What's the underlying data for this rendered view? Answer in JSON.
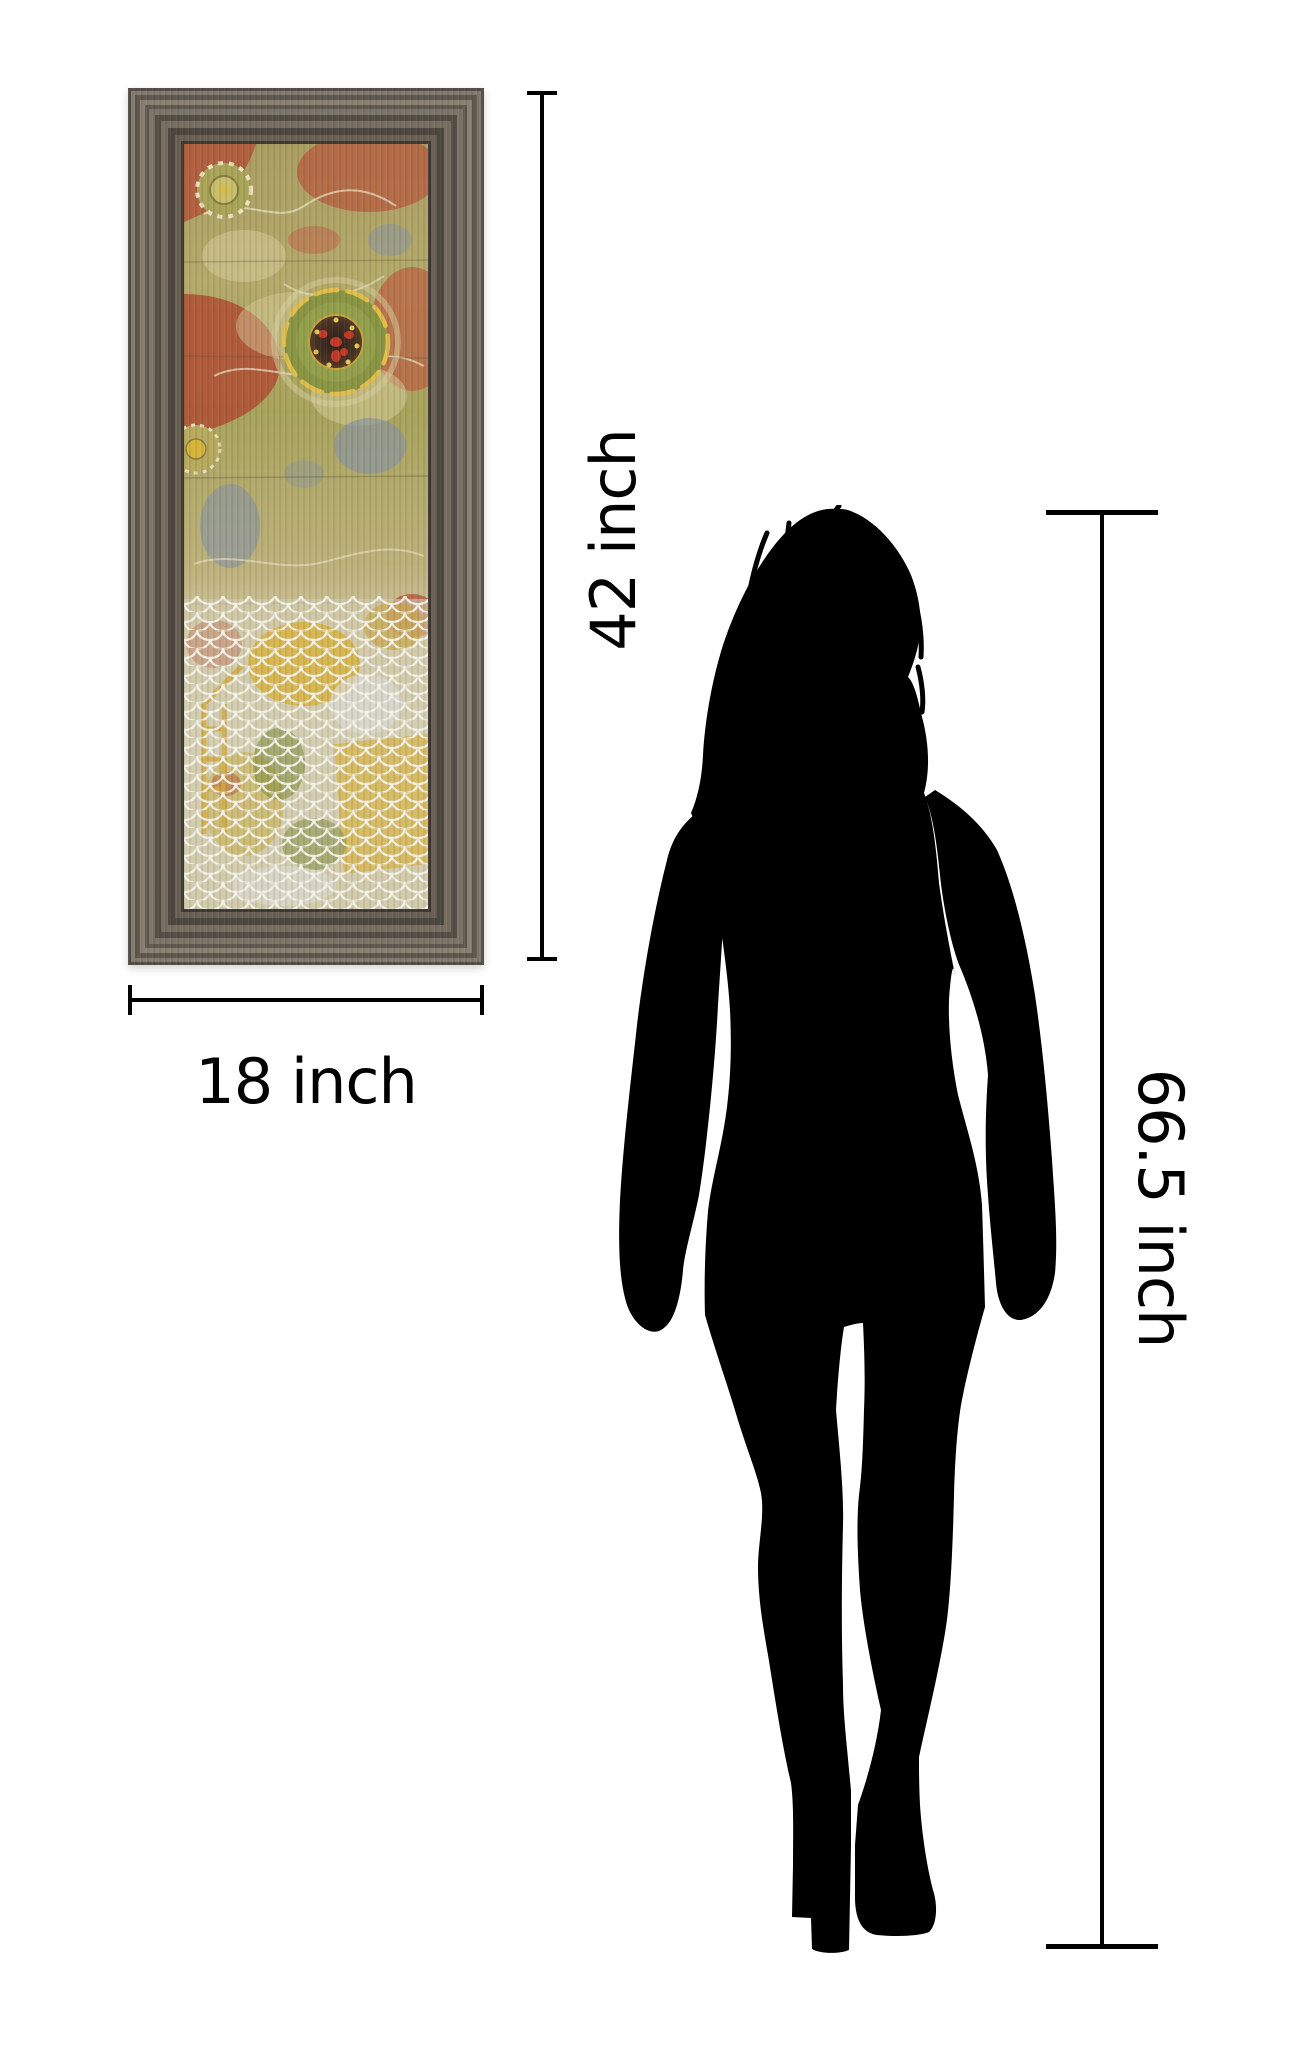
{
  "page": {
    "background_color": "#ffffff"
  },
  "artwork": {
    "name": "framed abstract floral art print",
    "frame_color": "#6e665c",
    "width_label": "18 inch",
    "height_label": "42 inch"
  },
  "person": {
    "icon": "woman-silhouette",
    "color": "#000000",
    "height_label": "66.5 inch"
  },
  "dimensions": {
    "line_color": "#000000"
  }
}
